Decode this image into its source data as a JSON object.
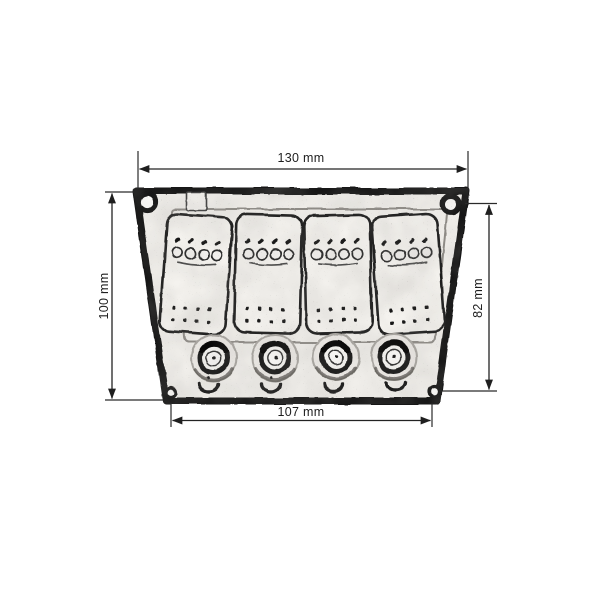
{
  "drawing": {
    "subject": "4-gang rocker switch panel with push-button circuit breakers",
    "style": "black-and-white scanned dimensional diagram",
    "dimensions": {
      "top_width": {
        "label": "130 mm",
        "value": 130,
        "unit": "mm",
        "orientation": "horizontal"
      },
      "left_height": {
        "label": "100 mm",
        "value": 100,
        "unit": "mm",
        "orientation": "vertical"
      },
      "right_height": {
        "label": "82 mm",
        "value": 82,
        "unit": "mm",
        "orientation": "vertical"
      },
      "bottom_width": {
        "label": "107 mm",
        "value": 107,
        "unit": "mm",
        "orientation": "horizontal"
      }
    },
    "panel": {
      "rocker_switches": 4,
      "circuit_breakers": 4,
      "corner_screw_holes": 4
    },
    "colors": {
      "background": "#ffffff",
      "ink": "#1c1c1c",
      "panel_face": "#f1efeb"
    }
  }
}
